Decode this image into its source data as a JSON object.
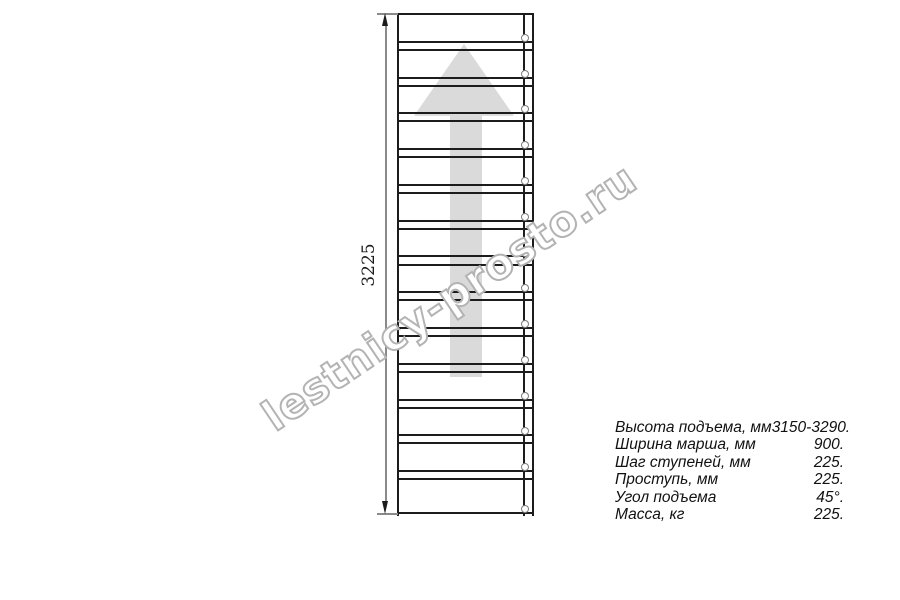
{
  "watermark": {
    "text": "lestnicy-prosto.ru"
  },
  "drawing": {
    "dimension_label": "3225",
    "treads_count": 14
  },
  "specs": {
    "rows": [
      {
        "label": "Высота подъема, мм",
        "value": "3150-3290."
      },
      {
        "label": "Ширина марша, мм",
        "value": "900."
      },
      {
        "label": "Шаг ступеней, мм",
        "value": "225."
      },
      {
        "label": "Проступь, мм",
        "value": "225."
      },
      {
        "label": "Угол подъема",
        "value": "45°."
      },
      {
        "label": "Масса, кг",
        "value": "225."
      }
    ]
  },
  "colors": {
    "line": "#1c1c1c",
    "dimension_line": "#8a8a8a",
    "arrow_fill": "#dadada",
    "watermark_outline": "#b3b3b3"
  }
}
